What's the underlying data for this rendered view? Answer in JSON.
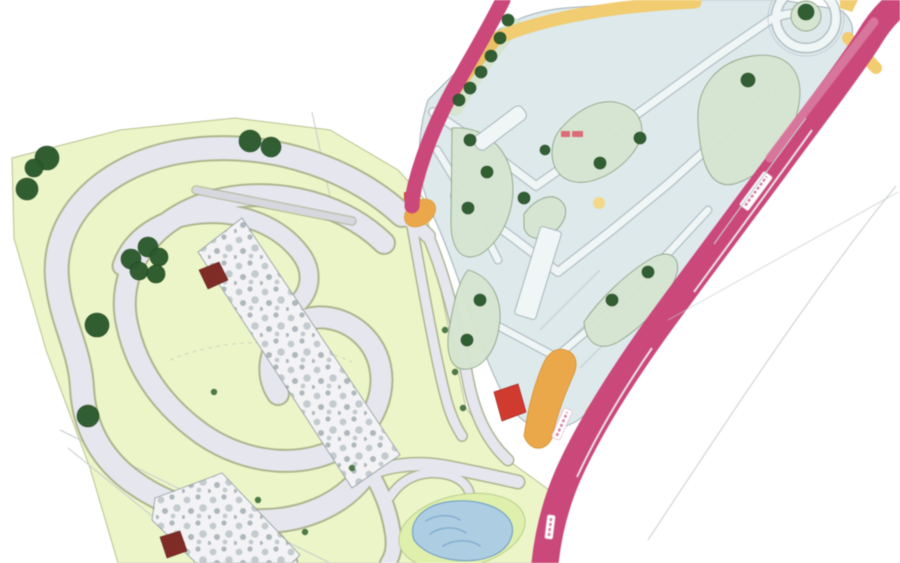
{
  "map": {
    "kind": "architectural site plan",
    "subject": "karting circuit with paddock area, access roads and pond"
  },
  "colors": {
    "background": "#ffffff",
    "site_green": "#ecf5c9",
    "track_grey": "#e6e6ee",
    "track_edge": "#a3ab86",
    "straight_grey": "#d7d8df",
    "tree_green": "#2d5a2e",
    "shrub_green": "#3c6b3a",
    "paddock_blue": "#dee9ec",
    "paddock_edge": "#9fb0b4",
    "island_sage": "#d5e5d0",
    "island_edge": "#8ba382",
    "lane_white": "#f0f5f6",
    "lane_edge": "#a3b2b6",
    "road_magenta": "#c9497b",
    "road_pink_light": "#d981a4",
    "band_yellow": "#f0cc72",
    "band_tan": "#eabf66",
    "strip_orange": "#e9a84c",
    "building_red": "#cf3c30",
    "building_dark_red": "#7e2c26",
    "rock_fill": "#f3f3f5",
    "rock_edge": "#98a1a5",
    "rock_speckle_1": "#c3cbcf",
    "rock_speckle_2": "#aeb8bc",
    "pond_green": "#def0ad",
    "pond_water": "#aecde2",
    "pond_edge": "#7aa3c4",
    "pond_ripple": "#7fa8cc",
    "sketch_line": "#c9cdb9",
    "survey_grey": "#c6cbce",
    "label_red": "#d8626e",
    "dot_yellow": "#f2d884"
  },
  "features": {
    "trees_site": [
      [
        47,
        158,
        12
      ],
      [
        34,
        168,
        9
      ],
      [
        27,
        189,
        11
      ],
      [
        250,
        141,
        11
      ],
      [
        271,
        147,
        10
      ],
      [
        148,
        247,
        10
      ],
      [
        131,
        259,
        10
      ],
      [
        159,
        257,
        9
      ],
      [
        139,
        271,
        9
      ],
      [
        156,
        274,
        9
      ],
      [
        97,
        325,
        12
      ],
      [
        88,
        416,
        11
      ]
    ],
    "trees_paddock": [
      [
        806,
        12,
        8
      ],
      [
        748,
        80,
        7
      ],
      [
        640,
        138,
        6
      ],
      [
        600,
        163,
        6
      ],
      [
        508,
        20,
        6
      ],
      [
        500,
        38,
        6
      ],
      [
        491,
        56,
        6
      ],
      [
        481,
        72,
        6
      ],
      [
        470,
        88,
        6
      ],
      [
        459,
        100,
        6
      ],
      [
        470,
        140,
        6
      ],
      [
        487,
        172,
        6
      ],
      [
        468,
        208,
        6
      ],
      [
        480,
        300,
        6
      ],
      [
        467,
        340,
        6
      ],
      [
        612,
        300,
        6
      ],
      [
        648,
        272,
        6
      ],
      [
        524,
        198,
        6
      ],
      [
        545,
        150,
        5
      ]
    ],
    "shrub_dots": [
      [
        445,
        330
      ],
      [
        455,
        372
      ],
      [
        463,
        408
      ],
      [
        258,
        500
      ],
      [
        305,
        532
      ],
      [
        352,
        468
      ],
      [
        214,
        392
      ]
    ],
    "road_banners": [
      {
        "cx": 756,
        "cy": 191,
        "w": 42,
        "h": 11,
        "rot": -53.5
      },
      {
        "cx": 562,
        "cy": 424,
        "w": 32,
        "h": 9,
        "rot": -66
      },
      {
        "cx": 550,
        "cy": 527,
        "w": 24,
        "h": 8,
        "rot": -83
      }
    ],
    "dark_red_buildings": [
      [
        [
          199,
          270
        ],
        [
          219,
          262
        ],
        [
          228,
          280
        ],
        [
          208,
          289
        ]
      ],
      [
        [
          160,
          537
        ],
        [
          180,
          531
        ],
        [
          187,
          551
        ],
        [
          167,
          558
        ]
      ]
    ],
    "bright_red_buildings": [
      [
        [
          494,
          392
        ],
        [
          518,
          384
        ],
        [
          526,
          412
        ],
        [
          502,
          421
        ]
      ]
    ],
    "junction_marker": {
      "cx": 420,
      "cy": 213,
      "rx": 17,
      "ry": 12,
      "rot": -35,
      "dot": [
        404,
        192,
        9,
        8
      ]
    },
    "label_marks": [
      {
        "x": 561,
        "y": 131,
        "w": 9,
        "h": 6
      },
      {
        "x": 572,
        "y": 131,
        "w": 11,
        "h": 6
      }
    ],
    "yellow_dots": [
      [
        599,
        203,
        6
      ]
    ]
  }
}
